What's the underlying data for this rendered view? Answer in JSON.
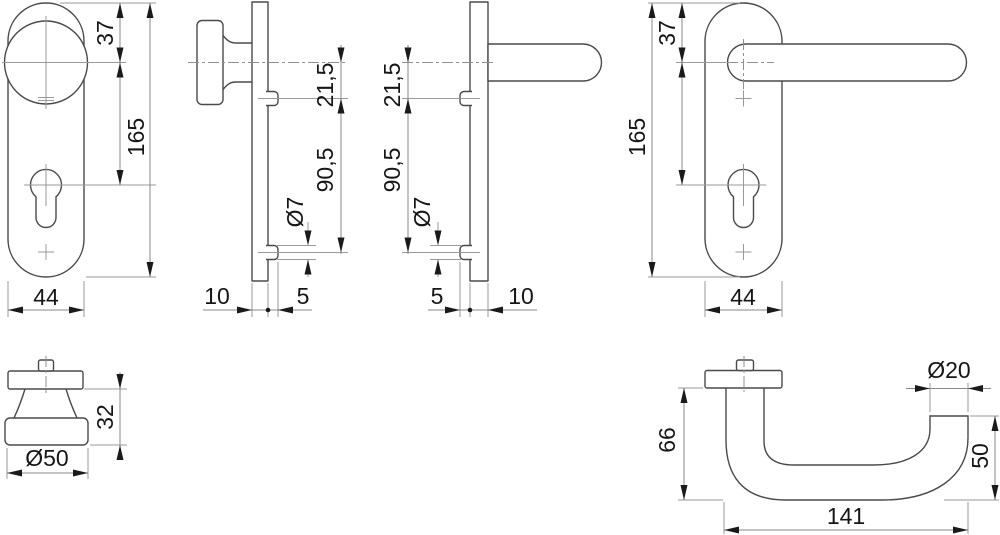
{
  "colors": {
    "background": "#ffffff",
    "outline": "#4a4a4a",
    "thin_line": "#9a9a9a",
    "dimension_text": "#161616",
    "arrow": "#1a1a1a"
  },
  "figures": {
    "knob_plate_front": {
      "dims": {
        "top_to_knob_center": "37",
        "plate_height": "165",
        "plate_width": "44"
      }
    },
    "knob_plate_side": {
      "dims": {
        "knob_to_screw": "21,5",
        "screw_spacing": "90,5",
        "boss_diameter": "Ø7",
        "plate_thickness": "10",
        "boss_projection": "5"
      }
    },
    "lever_plate_side": {
      "dims": {
        "lever_to_screw": "21,5",
        "screw_spacing": "90,5",
        "boss_diameter": "Ø7",
        "boss_projection": "5",
        "plate_thickness": "10"
      }
    },
    "lever_plate_front": {
      "dims": {
        "top_to_lever_center": "37",
        "plate_height": "165",
        "plate_width": "44"
      }
    },
    "knob_detail": {
      "dims": {
        "knob_height": "32",
        "knob_diameter": "Ø50"
      }
    },
    "lever_detail": {
      "dims": {
        "lever_projection": "66",
        "grip_diameter": "Ø20",
        "end_height": "50",
        "lever_length": "141"
      }
    }
  }
}
